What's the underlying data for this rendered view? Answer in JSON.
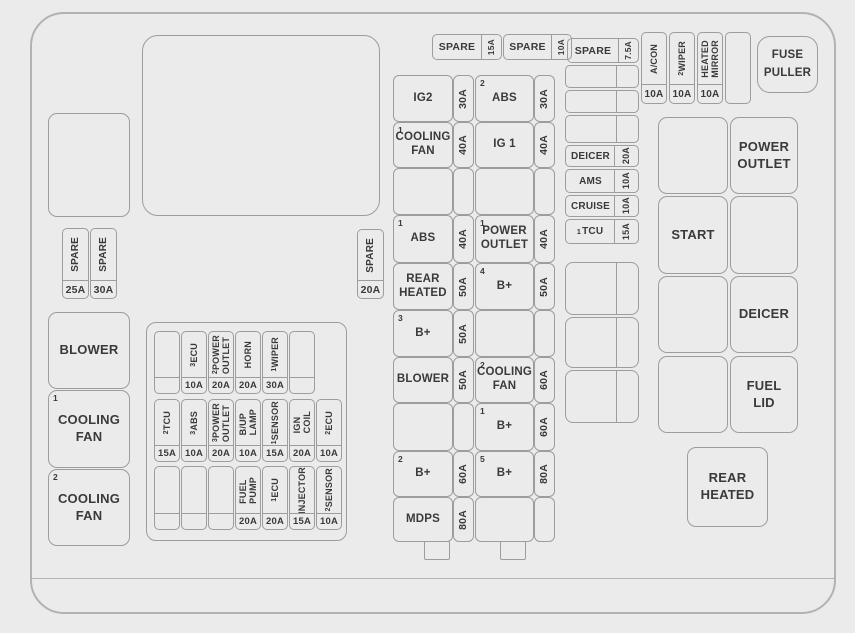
{
  "colors": {
    "background": "#ebebeb",
    "line": "#9d9d9d",
    "text": "#3a3a3a"
  },
  "top_spare_fuses": [
    {
      "label": "SPARE",
      "amp": "15A"
    },
    {
      "label": "SPARE",
      "amp": "10A"
    },
    {
      "label": "SPARE",
      "amp": "7.5A"
    }
  ],
  "left_spare_fuses": [
    {
      "label": "SPARE",
      "amp": "25A"
    },
    {
      "label": "SPARE",
      "amp": "30A"
    }
  ],
  "mid_spare_fuse": {
    "label": "SPARE",
    "amp": "20A"
  },
  "ac_group": {
    "fuses": [
      {
        "sup": "",
        "label": "A/CON",
        "amp": "10A"
      },
      {
        "sup": "2",
        "label": "WIPER",
        "amp": "10A"
      },
      {
        "sup": "",
        "label": "HEATED\nMIRROR",
        "amp": "10A"
      }
    ]
  },
  "fuse_puller": {
    "label": "FUSE\nPULLER"
  },
  "left_boxes": [
    {
      "sup": "",
      "label": "BLOWER"
    },
    {
      "sup": "1",
      "label": "COOLING\nFAN"
    },
    {
      "sup": "2",
      "label": "COOLING\nFAN"
    }
  ],
  "center_block": {
    "row1": [
      {
        "sup": "",
        "label": "",
        "amp": ""
      },
      {
        "sup": "3",
        "label": "ECU",
        "amp": "10A"
      },
      {
        "sup": "2",
        "label": "POWER\nOUTLET",
        "amp": "20A"
      },
      {
        "sup": "",
        "label": "HORN",
        "amp": "20A"
      },
      {
        "sup": "1",
        "label": "WIPER",
        "amp": "30A"
      },
      {
        "sup": "",
        "label": "",
        "amp": ""
      }
    ],
    "row2": [
      {
        "sup": "2",
        "label": "TCU",
        "amp": "15A"
      },
      {
        "sup": "3",
        "label": "ABS",
        "amp": "10A"
      },
      {
        "sup": "3",
        "label": "POWER\nOUTLET",
        "amp": "20A"
      },
      {
        "sup": "",
        "label": "B/UP\nLAMP",
        "amp": "10A"
      },
      {
        "sup": "1",
        "label": "SENSOR",
        "amp": "15A"
      },
      {
        "sup": "",
        "label": "IGN\nCOIL",
        "amp": "20A"
      },
      {
        "sup": "2",
        "label": "ECU",
        "amp": "10A"
      }
    ],
    "row3": [
      {
        "sup": "",
        "label": "",
        "amp": ""
      },
      {
        "sup": "",
        "label": "",
        "amp": ""
      },
      {
        "sup": "",
        "label": "",
        "amp": ""
      },
      {
        "sup": "",
        "label": "FUEL\nPUMP",
        "amp": "20A"
      },
      {
        "sup": "1",
        "label": "ECU",
        "amp": "20A"
      },
      {
        "sup": "",
        "label": "INJECTOR",
        "amp": "15A"
      },
      {
        "sup": "2",
        "label": "SENSOR",
        "amp": "10A"
      }
    ]
  },
  "main_column": {
    "rows": [
      {
        "l_sup": "",
        "l_label": "IG2",
        "l_amp": "30A",
        "r_sup": "2",
        "r_label": "ABS",
        "r_amp": "30A"
      },
      {
        "l_sup": "1",
        "l_label": "COOLING\nFAN",
        "l_amp": "40A",
        "r_sup": "",
        "r_label": "IG 1",
        "r_amp": "40A"
      },
      {
        "l_sup": "",
        "l_label": "",
        "l_amp": "",
        "r_sup": "",
        "r_label": "",
        "r_amp": ""
      },
      {
        "l_sup": "1",
        "l_label": "ABS",
        "l_amp": "40A",
        "r_sup": "1",
        "r_label": "POWER\nOUTLET",
        "r_amp": "40A"
      },
      {
        "l_sup": "",
        "l_label": "REAR\nHEATED",
        "l_amp": "50A",
        "r_sup": "4",
        "r_label": "B+",
        "r_amp": "50A"
      },
      {
        "l_sup": "3",
        "l_label": "B+",
        "l_amp": "50A",
        "r_sup": "",
        "r_label": "",
        "r_amp": ""
      },
      {
        "l_sup": "",
        "l_label": "BLOWER",
        "l_amp": "50A",
        "r_sup": "2",
        "r_label": "COOLING\nFAN",
        "r_amp": "60A"
      },
      {
        "l_sup": "",
        "l_label": "",
        "l_amp": "",
        "r_sup": "1",
        "r_label": "B+",
        "r_amp": "60A"
      },
      {
        "l_sup": "2",
        "l_label": "B+",
        "l_amp": "60A",
        "r_sup": "5",
        "r_label": "B+",
        "r_amp": "80A"
      },
      {
        "l_sup": "",
        "l_label": "MDPS",
        "l_amp": "80A",
        "r_sup": "",
        "r_label": "",
        "r_amp": ""
      }
    ]
  },
  "right_column": {
    "fuses": [
      {
        "sup": "",
        "label": "DEICER",
        "amp": "20A"
      },
      {
        "sup": "",
        "label": "AMS",
        "amp": "10A"
      },
      {
        "sup": "",
        "label": "CRUISE",
        "amp": "10A"
      },
      {
        "sup": "1",
        "label": "TCU",
        "amp": "15A"
      }
    ]
  },
  "relay_grid": {
    "power_outlet": "POWER\nOUTLET",
    "start": "START",
    "deicer": "DEICER",
    "fuel_lid": "FUEL\nLID",
    "rear_heated": "REAR\nHEATED"
  }
}
